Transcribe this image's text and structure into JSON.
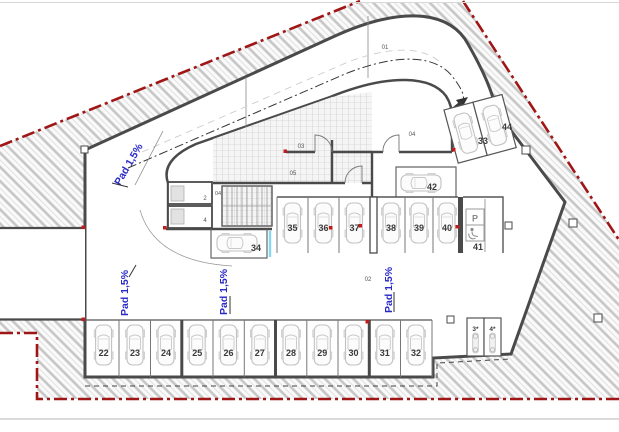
{
  "drawing": {
    "slope_label": "Pad 1,5%",
    "zone_labels": {
      "ramp": "01",
      "aisle": "02",
      "room_03": "03",
      "room_04": "04",
      "room_05": "05",
      "stair_area": "04",
      "storage_a": "2",
      "storage_b": "4"
    },
    "spots": {
      "bottom_row": [
        "22",
        "23",
        "24",
        "25",
        "26",
        "27",
        "28",
        "29",
        "30",
        "31",
        "32"
      ],
      "middle_left": [
        "35",
        "36",
        "37"
      ],
      "middle_right": [
        "38",
        "39",
        "40"
      ],
      "accessible": "41",
      "accessible_symbol": "P",
      "spot_34": "34",
      "spot_42": "42",
      "angled": [
        "33",
        "44"
      ],
      "moto": [
        "3*",
        "4*"
      ]
    },
    "colors": {
      "boundary_red": "#a01616",
      "slope_blue": "#2a2ac8",
      "wall_gray": "#4a4a4a",
      "car_gray": "#c2c2c2",
      "marker_red": "#c41a1a",
      "glass_cyan": "#86d7f0"
    }
  }
}
